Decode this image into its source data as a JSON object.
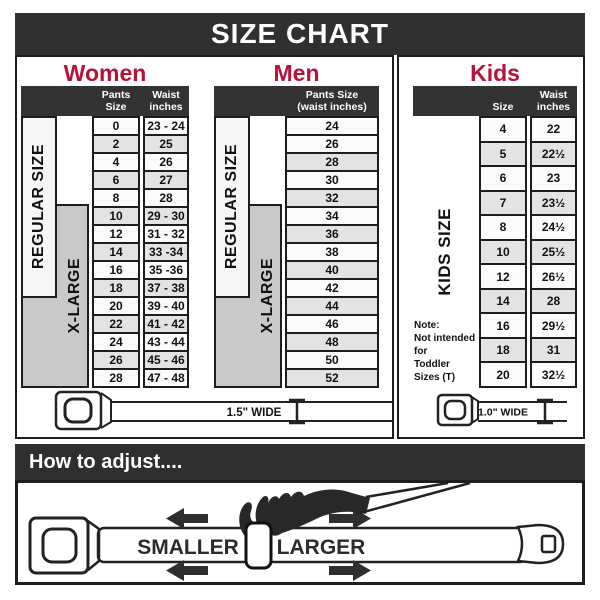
{
  "banner": {
    "title": "SIZE CHART"
  },
  "women": {
    "heading": "Women",
    "header": {
      "col1": "Pants Size",
      "col2": "Waist\ninches"
    },
    "labels": {
      "regular": "REGULAR SIZE",
      "xlarge": "X-LARGE"
    }
  },
  "men": {
    "heading": "Men",
    "header": {
      "col1": "Pants Size\n(waist inches)"
    },
    "labels": {
      "regular": "REGULAR SIZE",
      "xlarge": "X-LARGE"
    }
  },
  "kids": {
    "heading": "Kids",
    "header": {
      "col1": "Size",
      "col2": "Waist\ninches"
    },
    "label": "KIDS SIZE",
    "note": "Note:\nNot intended for\nToddler Sizes (T)"
  },
  "belts": {
    "adult_label": "1.5\" WIDE",
    "kids_label": "1.0\" WIDE"
  },
  "adjust": {
    "heading": "How to adjust....",
    "smaller": "SMALLER",
    "larger": "LARGER"
  },
  "colors": {
    "accent_red": "#b91237",
    "dark": "#303030",
    "row_shade": "#e3e3e3",
    "xlarge_gray": "#c9c9c9"
  },
  "chart_data": [
    {
      "type": "table",
      "title": "Women",
      "columns": [
        "Pants Size",
        "Waist inches"
      ],
      "rows": [
        [
          "0",
          "23 - 24"
        ],
        [
          "2",
          "25"
        ],
        [
          "4",
          "26"
        ],
        [
          "6",
          "27"
        ],
        [
          "8",
          "28"
        ],
        [
          "10",
          "29 - 30"
        ],
        [
          "12",
          "31 - 32"
        ],
        [
          "14",
          "33 -34"
        ],
        [
          "16",
          "35 -36"
        ],
        [
          "18",
          "37 - 38"
        ],
        [
          "20",
          "39 - 40"
        ],
        [
          "22",
          "41 - 42"
        ],
        [
          "24",
          "43 - 44"
        ],
        [
          "26",
          "45 - 46"
        ],
        [
          "28",
          "47 - 48"
        ]
      ]
    },
    {
      "type": "table",
      "title": "Men",
      "columns": [
        "Pants Size (waist inches)"
      ],
      "rows": [
        [
          "24"
        ],
        [
          "26"
        ],
        [
          "28"
        ],
        [
          "30"
        ],
        [
          "32"
        ],
        [
          "34"
        ],
        [
          "36"
        ],
        [
          "38"
        ],
        [
          "40"
        ],
        [
          "42"
        ],
        [
          "44"
        ],
        [
          "46"
        ],
        [
          "48"
        ],
        [
          "50"
        ],
        [
          "52"
        ]
      ]
    },
    {
      "type": "table",
      "title": "Kids",
      "columns": [
        "Size",
        "Waist inches"
      ],
      "rows": [
        [
          "4",
          "22"
        ],
        [
          "5",
          "22½"
        ],
        [
          "6",
          "23"
        ],
        [
          "7",
          "23½"
        ],
        [
          "8",
          "24½"
        ],
        [
          "10",
          "25½"
        ],
        [
          "12",
          "26½"
        ],
        [
          "14",
          "28"
        ],
        [
          "16",
          "29½"
        ],
        [
          "18",
          "31"
        ],
        [
          "20",
          "32½"
        ]
      ]
    }
  ]
}
